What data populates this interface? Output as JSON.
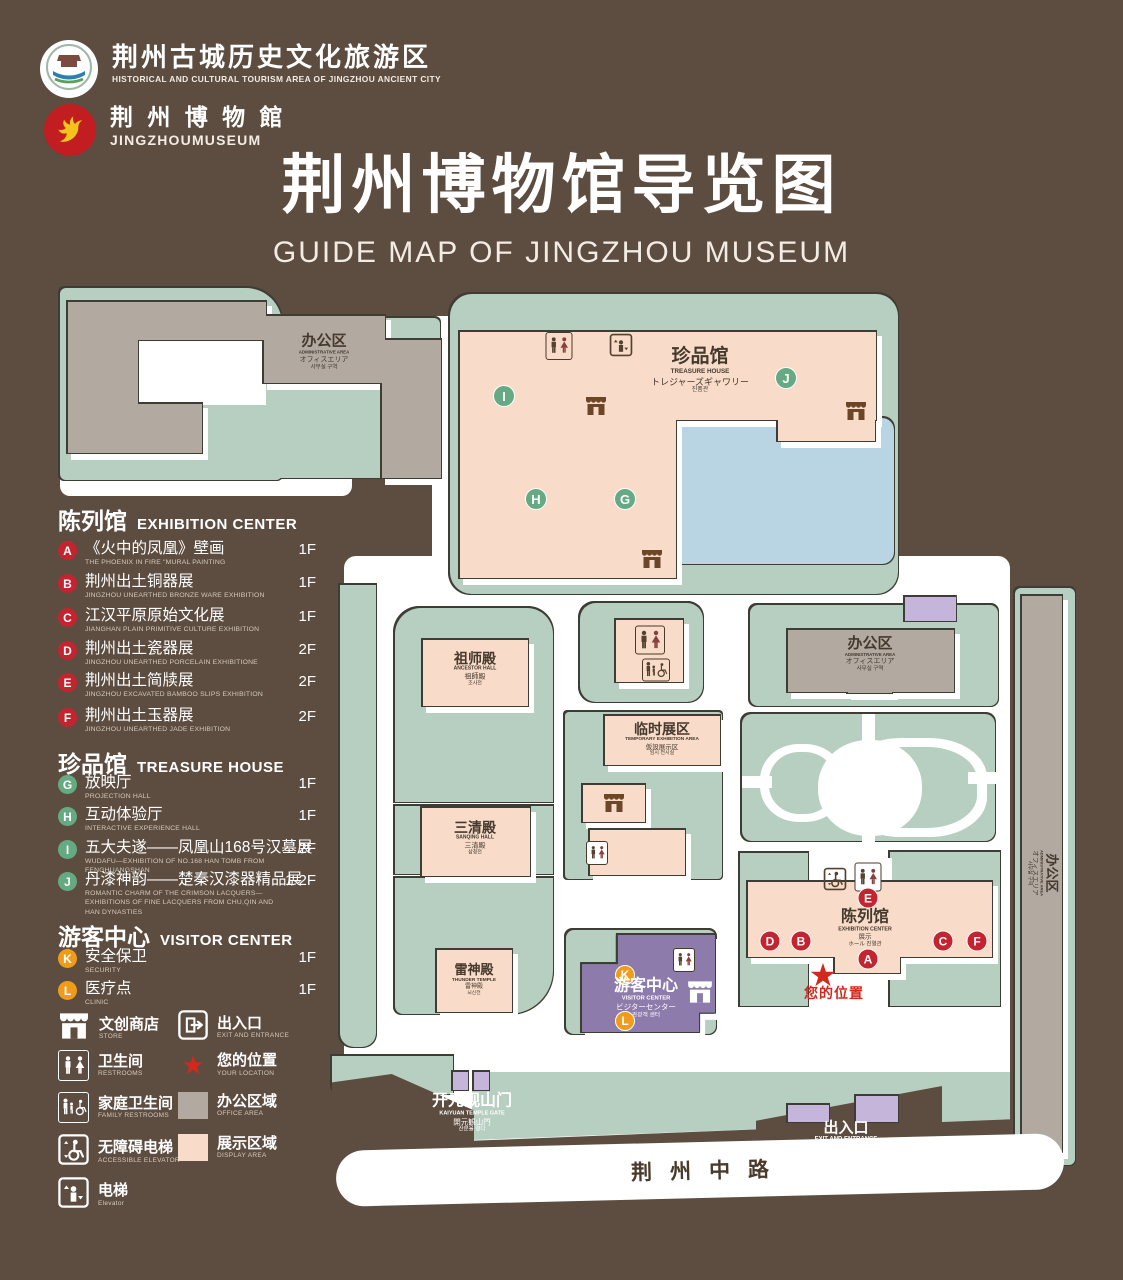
{
  "header": {
    "tourism": {
      "zh": "荆州古城历史文化旅游区",
      "en": "HISTORICAL AND CULTURAL TOURISM AREA OF JINGZHOU ANCIENT CITY"
    },
    "museum": {
      "zh": "荆 州 博 物 館",
      "en": "JINGZHOUMUSEUM"
    },
    "title": {
      "zh": "荆州博物馆导览图",
      "en": "GUIDE MAP OF JINGZHOU MUSEUM"
    }
  },
  "legend": {
    "exhibition": {
      "zh": "陈列馆",
      "en": "EXHIBITION CENTER",
      "items": [
        {
          "id": "A",
          "zh": "《火中的凤凰》壁画",
          "en": "THE PHOENIX IN FIRE \"MURAL PAINTING",
          "floor": "1F"
        },
        {
          "id": "B",
          "zh": "荆州出土铜器展",
          "en": "JINGZHOU UNEARTHED BRONZE WARE EXHIBITION",
          "floor": "1F"
        },
        {
          "id": "C",
          "zh": "江汉平原原始文化展",
          "en": "JIANGHAN PLAIN PRIMITIVE CULTURE EXHIBITION",
          "floor": "1F"
        },
        {
          "id": "D",
          "zh": "荆州出土瓷器展",
          "en": "JINGZHOU UNEARTHED PORCELAIN EXHIBITIONE",
          "floor": "2F"
        },
        {
          "id": "E",
          "zh": "荆州出土简牍展",
          "en": "JINGZHOU EXCAVATED BAMBOO SLIPS EXHIBITION",
          "floor": "2F"
        },
        {
          "id": "F",
          "zh": "荆州出土玉器展",
          "en": "JINGZHOU UNEARTHED JADE EXHIBITION",
          "floor": "2F"
        }
      ]
    },
    "treasure": {
      "zh": "珍品馆",
      "en": "TREASURE HOUSE",
      "items": [
        {
          "id": "G",
          "zh": "放映厅",
          "en": "PROJECTION HALL",
          "floor": "1F"
        },
        {
          "id": "H",
          "zh": "互动体验厅",
          "en": "INTERACTIVE EXPERIENCE HALL",
          "floor": "1F"
        },
        {
          "id": "I",
          "zh": "五大夫遂——凤凰山168号汉墓展",
          "en": "WUDAFU—EXHIBITION OF NO.168 HAN TOMB FROM FENGHUANGSHAN",
          "floor": "2F"
        },
        {
          "id": "J",
          "zh": "丹漆神韵——楚秦汉漆器精品展",
          "en": "ROMANTIC CHARM OF THE CRIMSON LACQUERS—EXHIBITIONS OF FINE LACQUERS FROM CHU,QIN AND HAN DYNASTIES",
          "floor": "1-2F"
        }
      ]
    },
    "visitor": {
      "zh": "游客中心",
      "en": "VISITOR CENTER",
      "items": [
        {
          "id": "K",
          "zh": "安全保卫",
          "en": "SECURITY",
          "floor": "1F"
        },
        {
          "id": "L",
          "zh": "医疗点",
          "en": "CLINIC",
          "floor": "1F"
        }
      ]
    },
    "symbols": {
      "store": {
        "zh": "文创商店",
        "en": "STORE"
      },
      "exit": {
        "zh": "出入口",
        "en": "EXIT AND ENTRANCE"
      },
      "restrooms": {
        "zh": "卫生间",
        "en": "RESTROOMS"
      },
      "location": {
        "zh": "您的位置",
        "en": "YOUR LOCATION"
      },
      "family": {
        "zh": "家庭卫生间",
        "en": "FAMILY RESTROOMS"
      },
      "office": {
        "zh": "办公区域",
        "en": "OFFICE AREA"
      },
      "accessible": {
        "zh": "无障碍电梯",
        "en": "ACCESSIBLE ELEVATOR"
      },
      "display": {
        "zh": "展示区域",
        "en": "DISPLAY AREA"
      },
      "elevator": {
        "zh": "电梯",
        "en": "Elevator"
      }
    }
  },
  "map": {
    "admin": {
      "zh": "办公区",
      "en": "ADMINISTRATIVE AREA",
      "ja": "オフィスエリア",
      "ko": "사무실 구역"
    },
    "treasure_house": {
      "zh": "珍品馆",
      "en": "TREASURE HOUSE",
      "ja": "トレジャーズギャワリー",
      "ko": "진품관"
    },
    "ancestor_hall": {
      "zh": "祖师殿",
      "en": "ANCESTOR HALL",
      "ja": "祖師殿",
      "ko": "조사전"
    },
    "sanqing_hall": {
      "zh": "三清殿",
      "en": "SANQING HALL",
      "ja": "三清殿",
      "ko": "삼청전"
    },
    "thunder_temple": {
      "zh": "雷神殿",
      "en": "THUNDER TEMPLE",
      "ja": "雷神殿",
      "ko": "뇌신전"
    },
    "temporary": {
      "zh": "临时展区",
      "en": "TEMPORARY EXHIBITION AREA",
      "ja": "仮設展示区",
      "ko": "임시 전시실"
    },
    "exhibition_center": {
      "zh": "陈列馆",
      "en": "EXHIBITION CENTER",
      "ja": "展示",
      "ko": "ホール 진열관"
    },
    "visitor_center": {
      "zh": "游客中心",
      "en": "VISITOR CENTER",
      "ja": "ビジターセンター",
      "ko": "관광객 센터"
    },
    "gate": {
      "zh": "开元观山门",
      "en": "KAIYUAN TEMPLE GATE",
      "ja": "開元観山門",
      "ko": "산문을 열다"
    },
    "exit": {
      "zh": "出入口",
      "en": "EXIT AND ENTRANCE",
      "ja": "出入口",
      "ko": "출입구"
    },
    "road": {
      "zh": "荆州中路"
    },
    "your_location": {
      "zh": "您的位置"
    }
  },
  "icons": {
    "star": "★"
  },
  "colors": {
    "background": "#5d4d40",
    "green": "#b7cfc1",
    "display_pink": "#f8dbc9",
    "office_gray": "#b2aaa1",
    "lake_blue": "#b9d4e3",
    "visitor_purple": "#8d7cab",
    "badge_red": "#c32430",
    "badge_green": "#66aa84",
    "badge_orange": "#ef9c1b",
    "location_red": "#d3281e"
  }
}
